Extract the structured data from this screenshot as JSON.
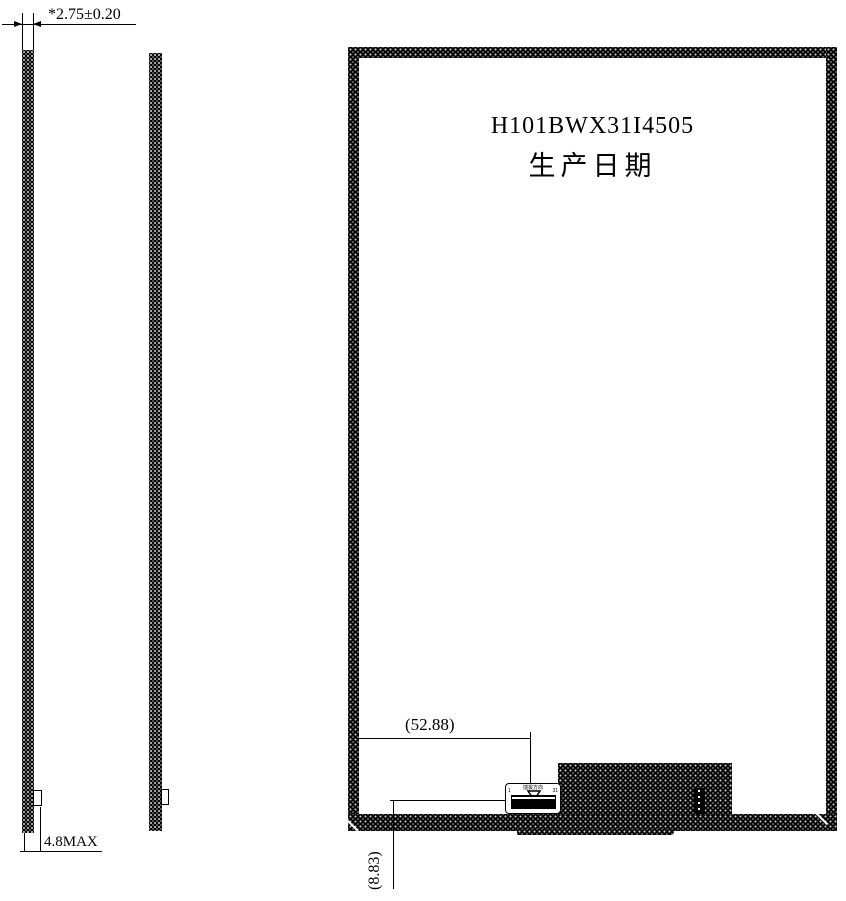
{
  "drawing": {
    "colors": {
      "ink": "#000000",
      "paper": "#ffffff"
    },
    "dimensions": {
      "thickness": "*2.75±0.20",
      "max_thickness": "4.8MAX",
      "connector_offset_x": "(52.88)",
      "connector_offset_y": "(8.83)"
    },
    "panel": {
      "model": "H101BWX31I4505",
      "production_date_label": "生产日期"
    },
    "connector": {
      "insert_direction_label": "插拔方向",
      "pin_first": "1",
      "pin_last": "31"
    }
  }
}
